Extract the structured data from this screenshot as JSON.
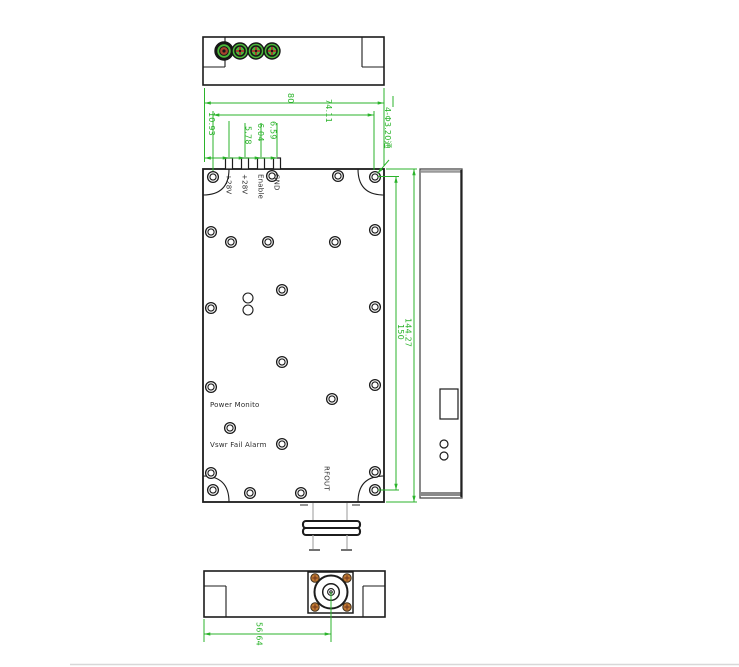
{
  "drawing": {
    "pin_labels": [
      "+28V",
      "+28V",
      "Enable",
      "GND"
    ],
    "front_labels": {
      "power_monitor": "Power Monito",
      "vswr_alarm": "Vswr Fail Alarm",
      "rf_out": "RFOUT"
    },
    "dimensions": {
      "top_width": "80",
      "hole_span_horizontal": "74.11",
      "pin1_offset": "10.93",
      "pin_pitch_1": "5.78",
      "pin_pitch_2": "6.04",
      "pin_pitch_3": "6.59",
      "mounting_holes_note": "4-Φ3.20通",
      "body_height": "150",
      "hole_span_vertical": "144.27",
      "rf_connector_offset": "56.64"
    },
    "colors": {
      "dimension_green": "#2bb32b",
      "outline_black": "#1c1c1c",
      "hidden_gray": "#aaaaaa",
      "feedthrough_green": "#4cb93a",
      "feedthrough_red": "#a8442e",
      "screw_orange": "#c17a33"
    }
  }
}
